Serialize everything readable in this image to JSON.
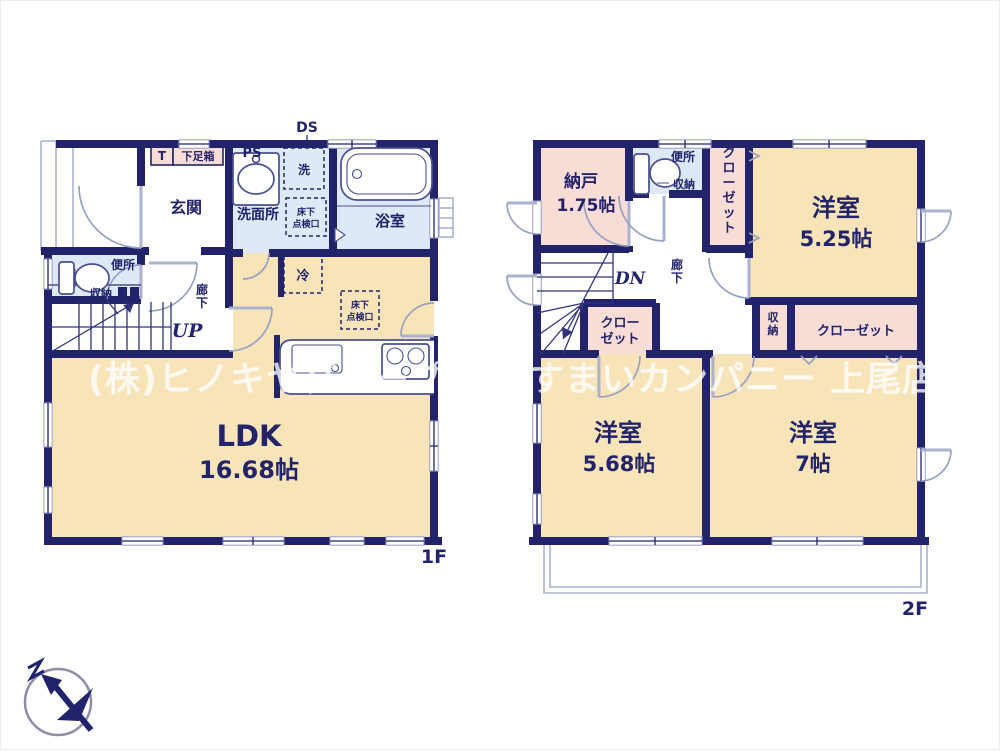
{
  "watermark": "(株)ヒノキヤグループ まいすまいカンパニー 上尾店",
  "colors": {
    "wall_navy": "#23236b",
    "room_cream": "#f7e5b9",
    "room_pink": "#f8dcd6",
    "room_blue": "#dfe8f6"
  },
  "compass": {
    "north_label": "N"
  },
  "floor1": {
    "floor_label": "1F",
    "duct_label": "DS",
    "pipe_space_label": "PS",
    "entrance_label": "玄関",
    "entrance_t_label": "T",
    "shoe_box_label": "下足箱",
    "washroom_label": "洗面所",
    "washer_label": "洗",
    "underfloor_l1": "床下",
    "underfloor_l2": "点検口",
    "bath_label": "浴室",
    "toilet_label": "便所",
    "toilet_storage_label": "収納",
    "hallway_label": "廊下",
    "stairs_label": "UP",
    "fridge_label": "冷",
    "kitchen_underfloor_l1": "床下",
    "kitchen_underfloor_l2": "点検口",
    "ldk_label": "LDK",
    "ldk_area": "16.68帖"
  },
  "floor2": {
    "floor_label": "2F",
    "storeroom_label": "納戸",
    "storeroom_area": "1.75帖",
    "toilet_label": "便所",
    "toilet_storage_label": "収納",
    "closet_right_label": "クローゼット",
    "bedroom1_label": "洋室",
    "bedroom1_area": "5.25帖",
    "stairs_label": "DN",
    "hallway_label": "廊下",
    "closet_hall_l1": "クロー",
    "closet_hall_l2": "ゼット",
    "storage_label": "収納",
    "closet_center_label": "クローゼット",
    "bedroom2_label": "洋室",
    "bedroom2_area": "5.68帖",
    "bedroom3_label": "洋室",
    "bedroom3_area": "7帖"
  }
}
